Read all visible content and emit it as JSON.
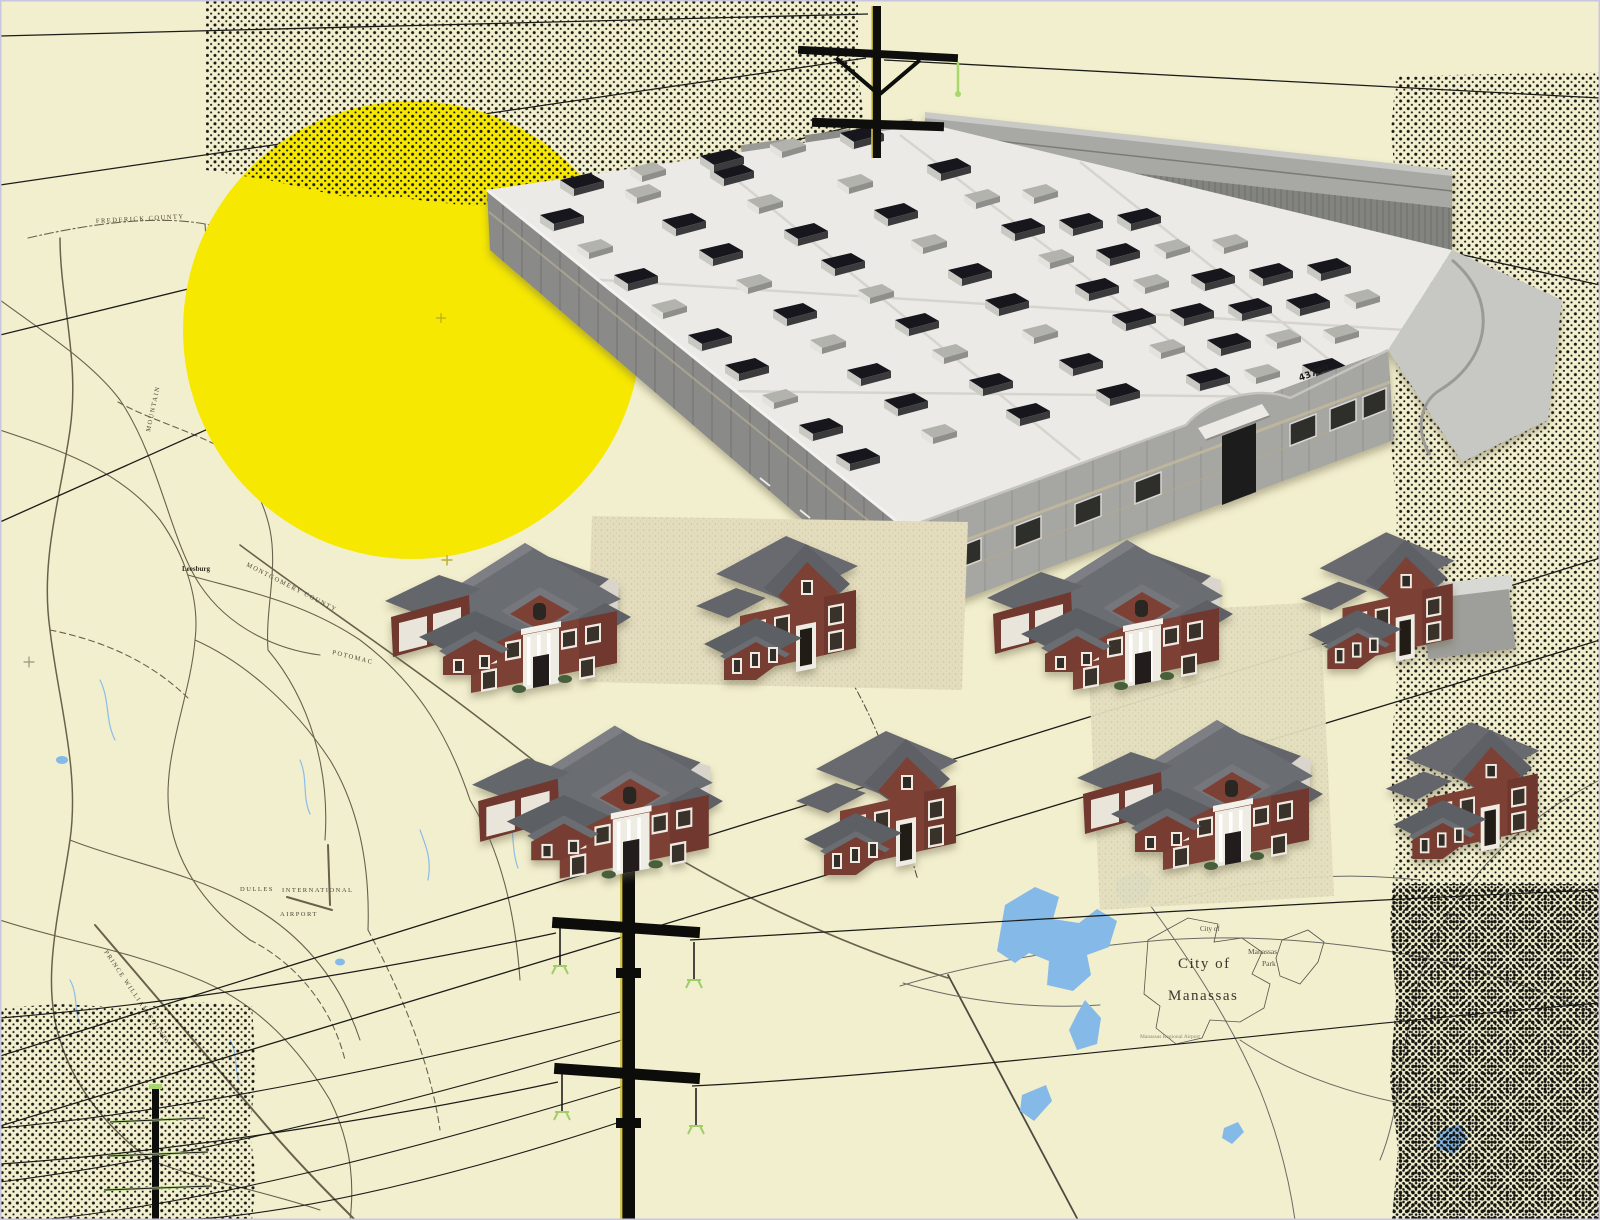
{
  "scene": {
    "background_color": "#f2efce",
    "sun_color": "#f6e800",
    "halftone_color": "#161613",
    "water_color": "#85b9e8",
    "brick_color": "#7b4035",
    "roof_color": "#6a6c70"
  },
  "map_labels": [
    {
      "id": "frederick-county",
      "text": "FREDERICK COUNTY"
    },
    {
      "id": "mountain",
      "text": "MOUNTAIN"
    },
    {
      "id": "leesburg",
      "text": "Leesburg"
    },
    {
      "id": "montgomery-county",
      "text": "MONTGOMERY COUNTY"
    },
    {
      "id": "potomac",
      "text": "POTOMAC"
    },
    {
      "id": "loudoun-county",
      "text": "Loudoun County"
    },
    {
      "id": "fauquier-county",
      "text": "Fauquier County"
    },
    {
      "id": "prince-william-county",
      "text": "PRINCE WILLIAM COUNTY"
    },
    {
      "id": "dulles",
      "text": "DULLES"
    },
    {
      "id": "international",
      "text": "INTERNATIONAL"
    },
    {
      "id": "airport",
      "text": "AIRPORT"
    },
    {
      "id": "city-of-small",
      "text": "City of"
    },
    {
      "id": "manassas-park-1",
      "text": "Manassas"
    },
    {
      "id": "manassas-park-2",
      "text": "Park"
    },
    {
      "id": "city-of",
      "text": "City of"
    },
    {
      "id": "manassas",
      "text": "Manassas"
    },
    {
      "id": "regional-airport",
      "text": "Manassas Regional Airport"
    }
  ],
  "building": {
    "address_sign": "43790"
  }
}
